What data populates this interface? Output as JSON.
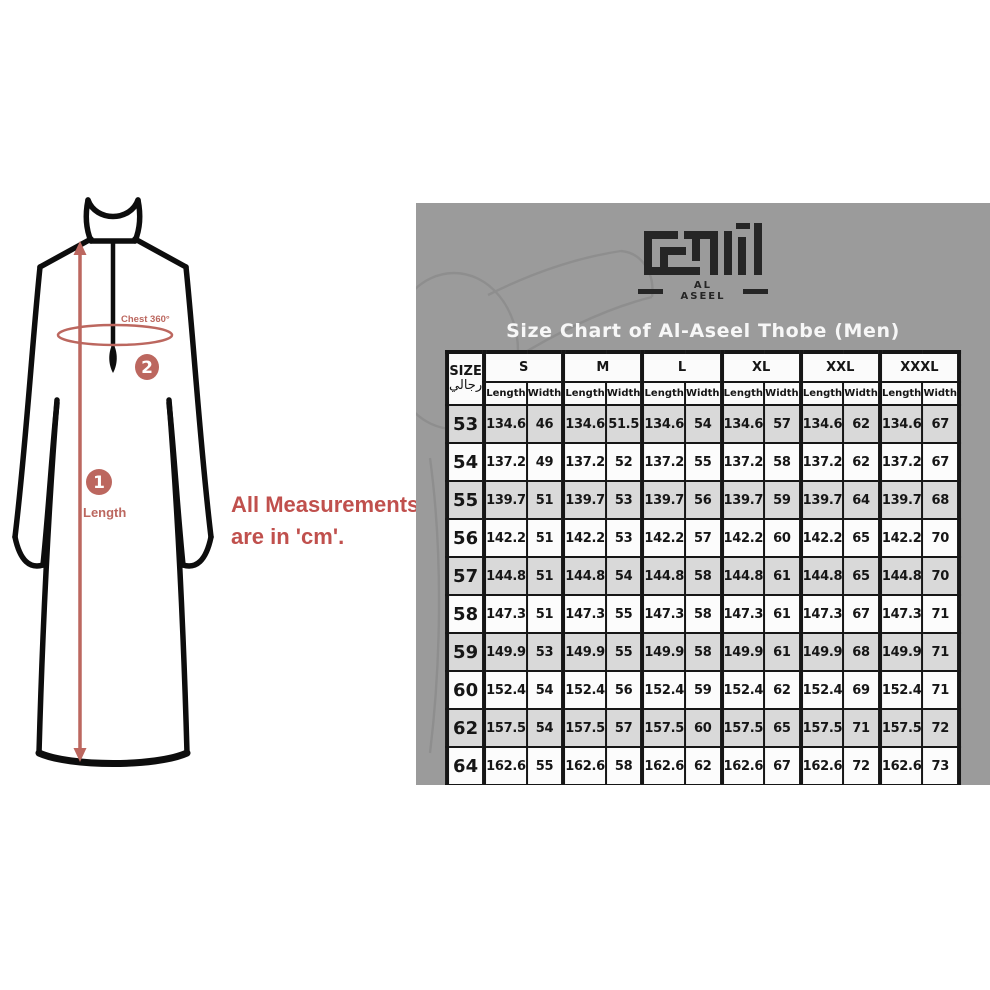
{
  "illustration": {
    "note_line1": "All Measurements",
    "note_line2": "are in 'cm'.",
    "labels": {
      "length": "Length",
      "chest": "Chest 360°"
    },
    "markers": {
      "length": "1",
      "chest": "2"
    },
    "accent_color": "#bc675f",
    "note_color": "#c0504d",
    "outline_color": "#0d0d0d"
  },
  "panel": {
    "bg_color": "#9b9b9b",
    "logo": {
      "brand": "AL ASEEL"
    },
    "title": "Size Chart of Al-Aseel Thobe (Men)",
    "title_color": "#f7f7f7",
    "table": {
      "corner_header": "SIZE",
      "corner_header_arabic": "رجالي",
      "group_headers": [
        "S",
        "M",
        "L",
        "XL",
        "XXL",
        "XXXL"
      ],
      "sub_headers": [
        "Length",
        "Width"
      ],
      "shade_row_color": "#d9d9d9",
      "border_color": "#161616"
    }
  },
  "chart_data": {
    "type": "table",
    "title": "Size Chart of Al-Aseel Thobe (Men)",
    "unit": "cm",
    "columns": [
      "SIZE رجالي",
      "S Length",
      "S Width",
      "M Length",
      "M Width",
      "L Length",
      "L Width",
      "XL Length",
      "XL Width",
      "XXL Length",
      "XXL Width",
      "XXXL Length",
      "XXXL Width"
    ],
    "rows": [
      [
        "53",
        "134.6",
        "46",
        "134.6",
        "51.5",
        "134.6",
        "54",
        "134.6",
        "57",
        "134.6",
        "62",
        "134.6",
        "67"
      ],
      [
        "54",
        "137.2",
        "49",
        "137.2",
        "52",
        "137.2",
        "55",
        "137.2",
        "58",
        "137.2",
        "62",
        "137.2",
        "67"
      ],
      [
        "55",
        "139.7",
        "51",
        "139.7",
        "53",
        "139.7",
        "56",
        "139.7",
        "59",
        "139.7",
        "64",
        "139.7",
        "68"
      ],
      [
        "56",
        "142.2",
        "51",
        "142.2",
        "53",
        "142.2",
        "57",
        "142.2",
        "60",
        "142.2",
        "65",
        "142.2",
        "70"
      ],
      [
        "57",
        "144.8",
        "51",
        "144.8",
        "54",
        "144.8",
        "58",
        "144.8",
        "61",
        "144.8",
        "65",
        "144.8",
        "70"
      ],
      [
        "58",
        "147.3",
        "51",
        "147.3",
        "55",
        "147.3",
        "58",
        "147.3",
        "61",
        "147.3",
        "67",
        "147.3",
        "71"
      ],
      [
        "59",
        "149.9",
        "53",
        "149.9",
        "55",
        "149.9",
        "58",
        "149.9",
        "61",
        "149.9",
        "68",
        "149.9",
        "71"
      ],
      [
        "60",
        "152.4",
        "54",
        "152.4",
        "56",
        "152.4",
        "59",
        "152.4",
        "62",
        "152.4",
        "69",
        "152.4",
        "71"
      ],
      [
        "62",
        "157.5",
        "54",
        "157.5",
        "57",
        "157.5",
        "60",
        "157.5",
        "65",
        "157.5",
        "71",
        "157.5",
        "72"
      ],
      [
        "64",
        "162.6",
        "55",
        "162.6",
        "58",
        "162.6",
        "62",
        "162.6",
        "67",
        "162.6",
        "72",
        "162.6",
        "73"
      ]
    ]
  }
}
